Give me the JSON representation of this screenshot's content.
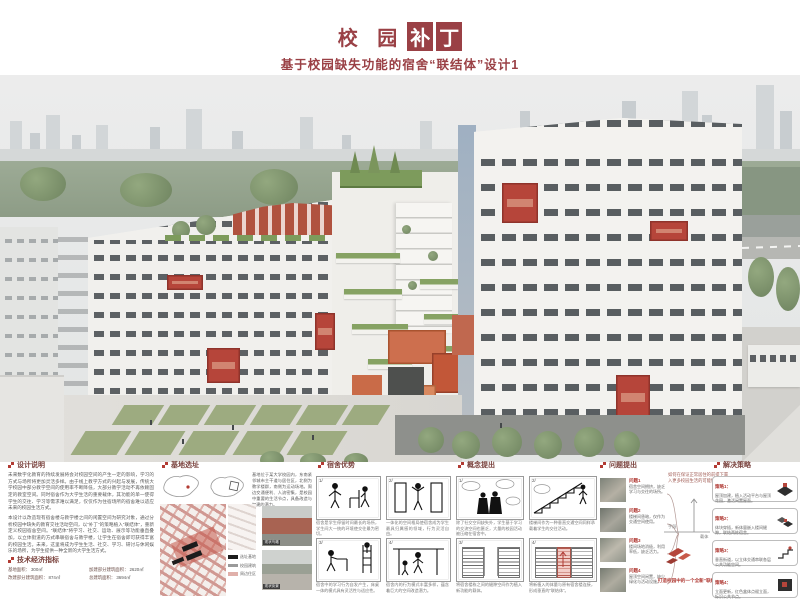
{
  "header": {
    "title_main": "校 园",
    "patch1": "补",
    "patch2": "丁",
    "subtitle": "基于校园缺失功能的宿舍“联结体”设计1"
  },
  "design_note": {
    "heading": "设计说明",
    "para1": "未来数字化教育的持续发展将会对校园空间的产生一定的影响，学习的方式与场所将更加灵活多样。由于线上教学方式的兴起与发展，传统大学校园中部分教学空间的使用率不断降低，大部分教学活动不再依赖固定的教室空间。同时宿舍作为大学生活的重要载体，其功能的单一使得学生的交往、学习等需求难以满足，仅仅作为住宿场所的宿舍难以适应未来的校园生活方式。",
    "para2": "本设计以改造现有宿舍楼与教学楼之间的闲置空间为研究对象，通过分析校园中缺失的教育交往活动空间，以“补丁”的策略植入“联结体”，重新定义校园宿舍空间。“联结体”将学习、社交、运动、展示等功能垂直叠加，以立体街道的方式串联宿舍与教学楼，让学生在宿舍即可获得丰富的校园生活。未来，这里将成为学生生活、社交、学习、研讨与休闲娱乐的场所，为学生提供一种全新的大学生活方式。"
  },
  "tech_index": {
    "heading": "技术经济指标",
    "stats": [
      {
        "label": "基地面积：",
        "value": "300㎡"
      },
      {
        "label": "改建部分建筑面积：",
        "value": "874㎡"
      },
      {
        "label": "加建部分建筑面积：",
        "value": "2620㎡"
      },
      {
        "label": "总建筑面积：",
        "value": "3694㎡"
      }
    ]
  },
  "site": {
    "heading": "基地选址",
    "desc": "基地位于某大学校园内，东南紧邻城市主干道与居住区，北侧为教学楼群，南侧为运动场地。周边交通便利、人流密集，是校园中重要的生活节点，具备改造与加建的潜力。",
    "legend": [
      {
        "label": "选址基地"
      },
      {
        "label": "校园建筑"
      },
      {
        "label": "周边住区"
      }
    ],
    "photo1_caption": "现状鸟瞰",
    "photo2_caption": "现状街景"
  },
  "advantages": {
    "heading": "宿舍优势",
    "items": [
      {
        "num": "1/",
        "caption": "宿舍是学生停留时间最长的场所，学生间大一统的环境使交往最为密切。"
      },
      {
        "num": "2/",
        "caption": "一体化的空间格局使宿舍成为学生最具归属感的领域，行为灵活自由。"
      },
      {
        "num": "3/",
        "caption": "宿舍中的学习行为自发产生，床桌一体的模式具有灵活性与适应性。"
      },
      {
        "num": "4/",
        "caption": "宿舍内的行为模式丰富多样，蕴含着巨大的空间改造潜力。"
      }
    ]
  },
  "concept": {
    "heading": "概念提出",
    "items": [
      {
        "num": "1/",
        "caption": "除了社交空间缺失外，学生基于学习的交流空间也匮乏，大量的校园活动被压缩在宿舍中。"
      },
      {
        "num": "2/",
        "caption": "楼梯间作为一种垂直交通空间同样承载着学生的交往活动。"
      },
      {
        "num": "3/",
        "caption": "将宿舍楼栋之间的缝隙空间作为植入新功能的载体。"
      },
      {
        "num": "4/",
        "caption": "将新植入的体量与原有宿舍楼连接，形成垂直的“联结体”。"
      }
    ]
  },
  "problems": {
    "heading": "问题提出",
    "items": [
      {
        "label": "问题1",
        "text": "宿舍空间拥挤，缺乏学习与交往的场所。"
      },
      {
        "label": "问题2",
        "text": "楼梯间昏暗，仅作为交通空间使用。"
      },
      {
        "label": "问题3",
        "text": "楼间场地消极，利用率低，缺乏活力。"
      },
      {
        "label": "问题4",
        "text": "屋顶空间闲置，缺少绿化与活动设施。"
      }
    ],
    "question": "如何在保证正常居住的前提下置入更多校园生活的可能性？",
    "axis_left": "手段",
    "axis_right": "载体",
    "conclusion": "打造校园中的一个全新“联结体”"
  },
  "strategies": {
    "heading": "解决策略",
    "items": [
      {
        "label": "策略1：",
        "text": "屋顶加建，植入活动平台与屋顶花园，激活闲置屋面。"
      },
      {
        "label": "策略2：",
        "text": "体块穿插，新体量嵌入楼间缝隙，联结两栋宿舍。"
      },
      {
        "label": "策略3：",
        "text": "垂直街道，以立体交通串联各层公共功能空间。"
      },
      {
        "label": "策略4：",
        "text": "立面更新，红色盒体点缀立面，标识公共节点。"
      }
    ]
  }
}
